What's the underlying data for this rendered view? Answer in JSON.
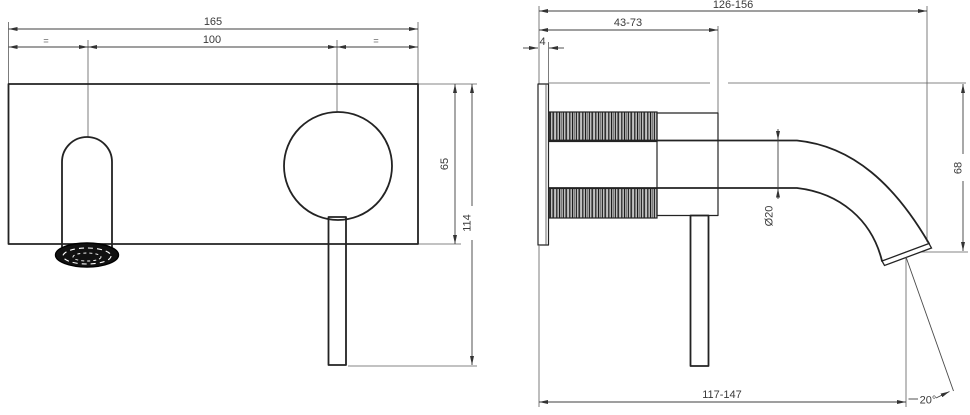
{
  "drawing": {
    "type": "technical-dimension-drawing",
    "subject": "wall-mounted basin mixer faucet, front view and side view",
    "colors": {
      "background": "#ffffff",
      "object_line": "#232323",
      "dimension_line": "#3f3f3f",
      "text": "#3a3a3a",
      "aerator_fill": "#111111"
    },
    "front_view": {
      "labels": {
        "plate_width": "165",
        "centers_distance": "100",
        "equal_left": "=",
        "equal_right": "=",
        "plate_height": "65",
        "overall_height": "114"
      }
    },
    "side_view": {
      "labels": {
        "overall_depth_range": "126-156",
        "wall_to_body_range": "43-73",
        "plate_thickness": "4",
        "spout_diameter": "Ø20",
        "spout_drop": "68",
        "spout_reach_range": "117-147",
        "outlet_angle": "20°"
      }
    }
  }
}
